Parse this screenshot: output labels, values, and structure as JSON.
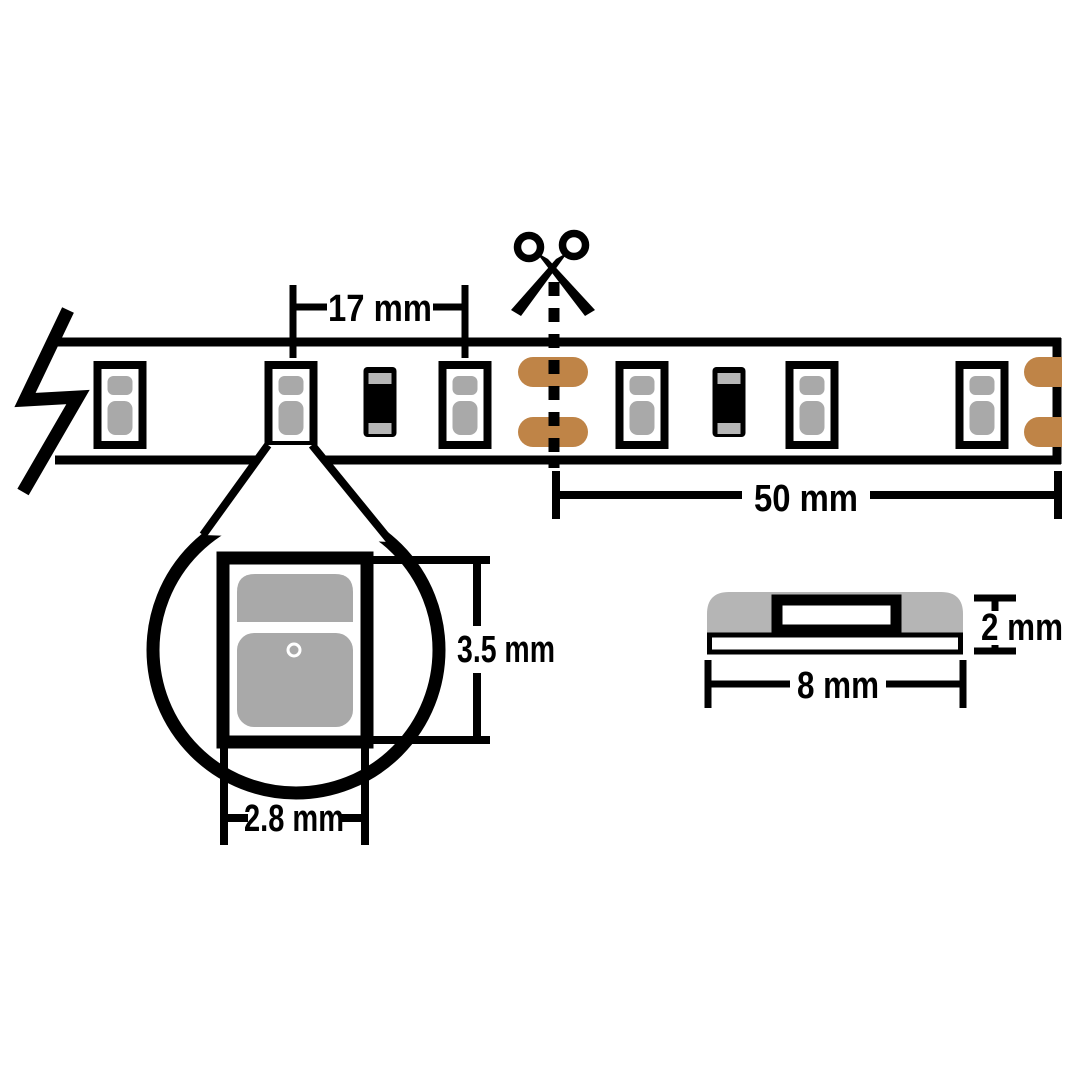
{
  "colors": {
    "background": "#ffffff",
    "outline": "#000000",
    "led_gray": "#a9a9a9",
    "terminal_gray": "#b7b7b7",
    "profile_gray": "#b5b5b5",
    "copper": "#bf8447"
  },
  "strip_view": {
    "pitch_label": "17 mm",
    "cut_length_label": "50 mm",
    "component_sequence": [
      "break",
      "led",
      "led",
      "resistor",
      "led",
      "cut-pads",
      "led",
      "resistor",
      "led",
      "led",
      "end-pads"
    ]
  },
  "magnified_view": {
    "height_label": "3.5 mm",
    "width_label": "2.8 mm"
  },
  "profile_view": {
    "height_label": "2 mm",
    "width_label": "8 mm"
  }
}
